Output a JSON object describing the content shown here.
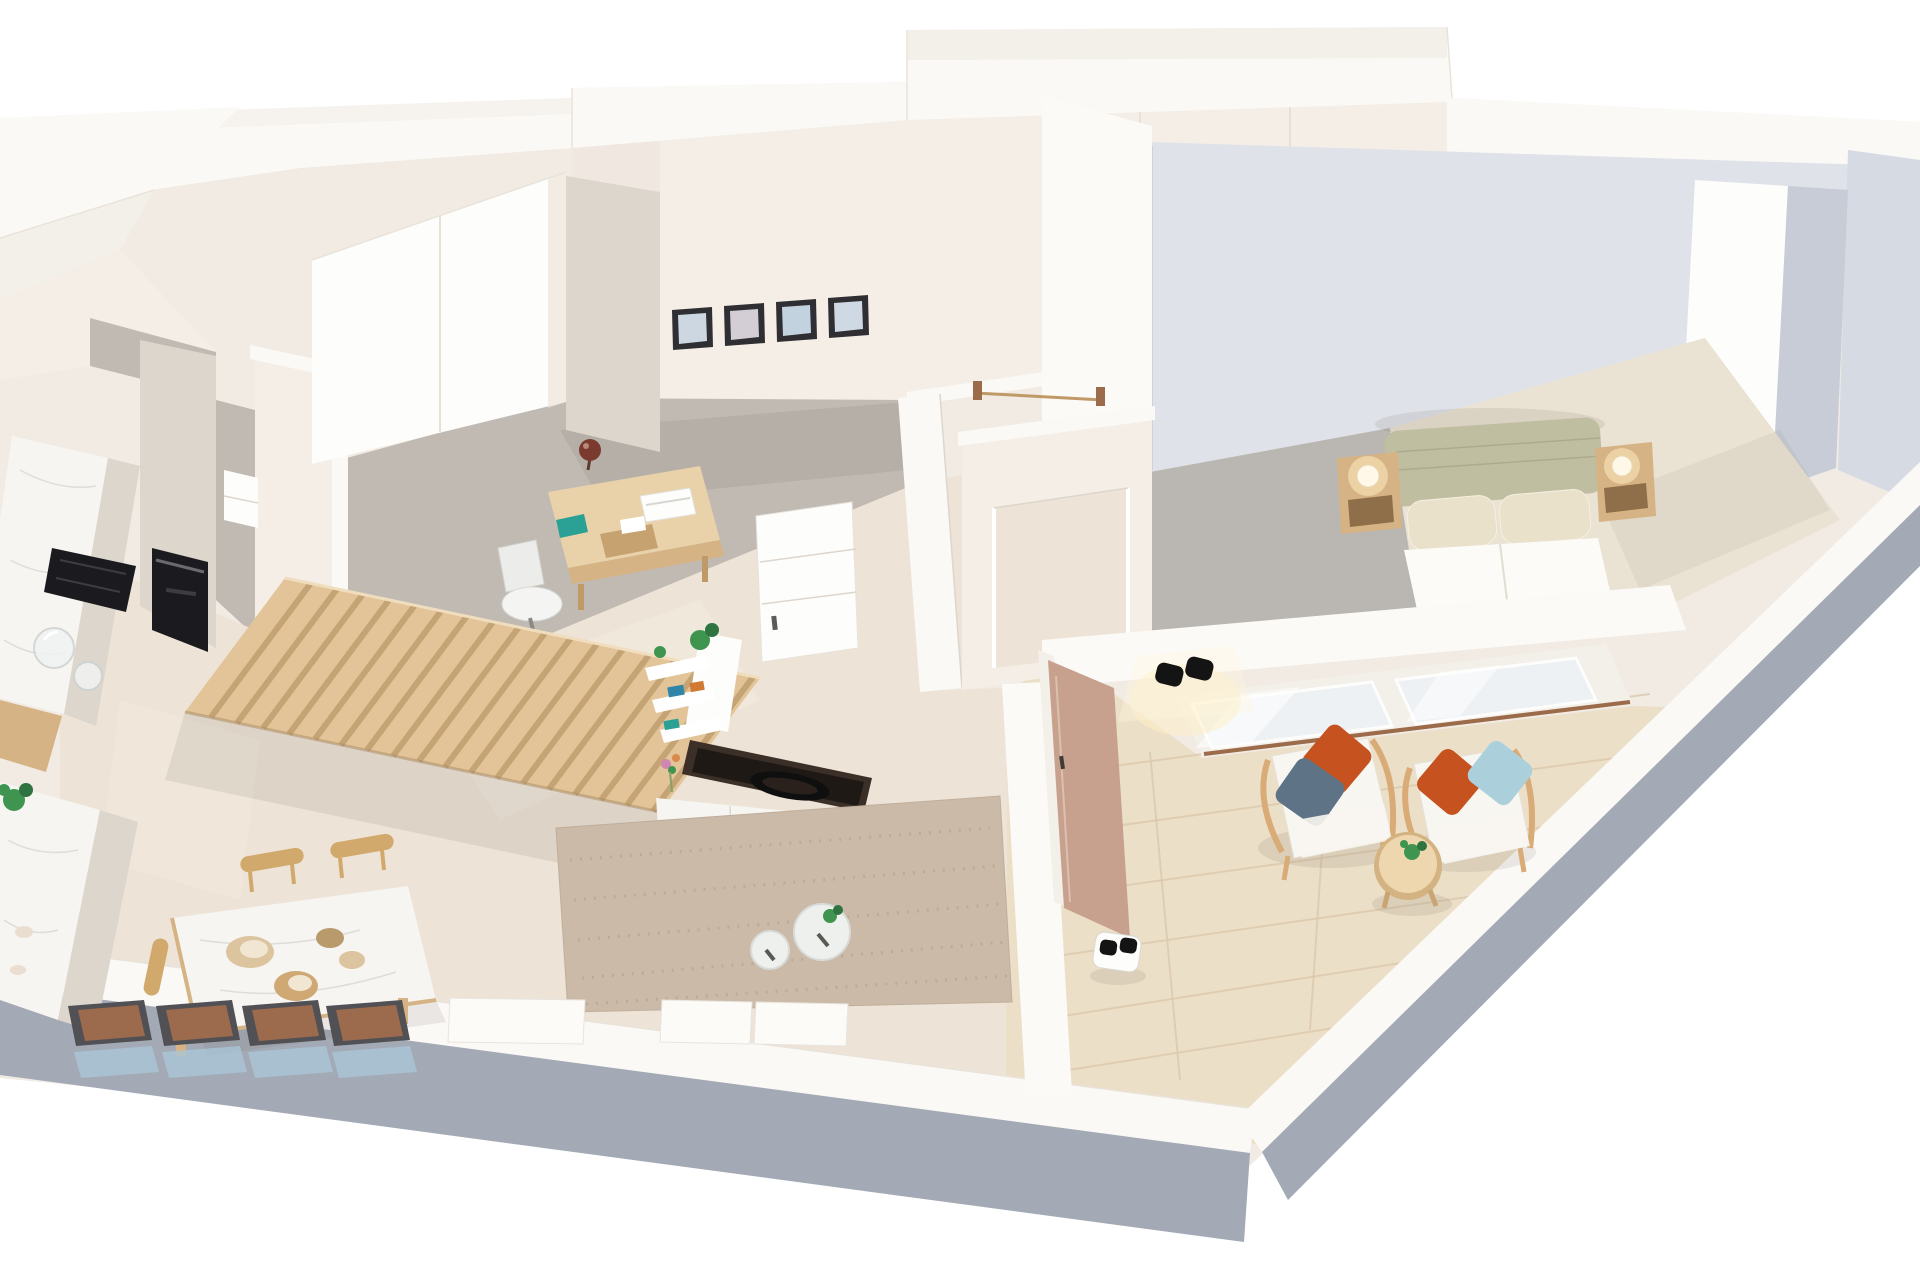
{
  "colors": {
    "bg": "#ffffff",
    "mass": "#f1ebe4",
    "wall_top": "#fbf9f6",
    "wall_top_shade": "#f3efe9",
    "wall_face_warm": "#f4eee6",
    "wall_face_warm_dark": "#ece4da",
    "wall_face_gray": "#dfe2e9",
    "wall_face_gray_dark": "#d6dae2",
    "wall_slot_gray": "#c7ccd6",
    "outer_face": "#a3aab5",
    "divider_white": "#fcfaf7",
    "floor_concrete": "#c1bab3",
    "floor_concrete_dark": "#b5aea7",
    "floor_cream": "#ede3d6",
    "floor_cream_light": "#f5eee2",
    "floor_wood": "#ecdfc8",
    "plank_line": "#dcc9ad",
    "carpet_gray": "#bab6b1",
    "carpet_cream": "#eae2d2",
    "rug": "#cbbaa8",
    "rug_dot": "#b3a08e",
    "marble": "#f7f5f2",
    "cabinet_beige": "#ddd6cd",
    "wood_light": "#e9d2a9",
    "wood_mid": "#d6b384",
    "wood_dark": "#c09a66",
    "slat_wood": "#e2c498",
    "slat_gap": "#bf9e70",
    "appliance_black": "#1b1b1f",
    "tv_frame": "#3b2f28",
    "tv_screen": "#1e1915",
    "tv_handle": "#0f0f0f",
    "headboard_sage": "#bfbea1",
    "pillow_cream": "#eae1cb",
    "duvet": "#fcfbf8",
    "pillow_orange": "#c5521f",
    "pillow_slate": "#5e7386",
    "pillow_blue": "#abd0dc",
    "plant": "#3f9550",
    "plant_dark": "#2e7340",
    "lamp_glow": "#ffefc4",
    "lamp_body": "#fff8e8",
    "sconce": "#141414",
    "door_tan": "#c7a18e",
    "chair_frame": "#515055",
    "chair_seat": "#9c6b4d",
    "shadow_blue": "#a9c7da",
    "shadow": "#6f6458",
    "white": "#ffffff",
    "near_white": "#fdfdfb",
    "glass_blue": "#eef2f5",
    "glass_jar": "#f1f3f2",
    "track_brown": "#9c6b4a",
    "sphere_lamp": "#7a3b2e",
    "teal": "#2ba094",
    "book_blue": "#2f86a8",
    "book_orange": "#d07a33",
    "frame_dark": "#2e2e33",
    "art_blue": "#ccd7e2",
    "art_pink": "#d3cdd6",
    "art_blue2": "#c3d2df",
    "art_blue3": "#cfd9e3",
    "shell": "#e9ded0",
    "bowl_tan": "#dcc49e",
    "bowl_brown": "#cfa873",
    "bowl_dark": "#b99a6d",
    "bowl_inner": "#f0e6d2",
    "seat_wood": "#d2a96c",
    "cushion_white": "#f8f6f1",
    "table_glass": "#eef0ed"
  },
  "scene": {
    "type": "3d-floor-plan-render",
    "view": "isometric-top",
    "rooms": [
      "kitchen",
      "dining-area",
      "home-office",
      "living-room",
      "hallway",
      "bedroom",
      "terrace"
    ],
    "counts": {
      "picture_frames": 4,
      "bar_chairs": 4,
      "dining_chairs": 3,
      "armchairs": 2,
      "living_coffee_tables": 2,
      "table_bowls": 4,
      "glass_jars": 2,
      "bedside_lamps": 2,
      "nightstands": 2,
      "sofa_sections": 3
    },
    "furniture": {
      "kitchen": [
        "tall-cabinet",
        "built-in-oven",
        "induction-hob",
        "marble-counter",
        "kitchen-island",
        "glass-jars",
        "shelf-niche",
        "plant",
        "shell-decor"
      ],
      "dining_area": [
        "marble-dining-table",
        "decor-bowls",
        "wooden-chairs",
        "bar-chair-row"
      ],
      "home_office": [
        "wardrobe",
        "tall-beige-cabinet",
        "picture-frames",
        "wooden-desk",
        "sphere-lamp",
        "laptop",
        "wood-tray",
        "office-chair",
        "white-drawer-door"
      ],
      "living_room": [
        "slat-partition",
        "white-shelf-unit",
        "tv-sideboard",
        "tv-panel",
        "speckled-rug",
        "round-glass-tables",
        "sofa"
      ],
      "hallway": [
        "coat-rail",
        "doorway-opening"
      ],
      "bedroom": [
        "sage-headboard-bed",
        "pillows",
        "duvet",
        "nightstand-left",
        "nightstand-right",
        "glow-lamps",
        "sliding-glass-door",
        "built-in-wardrobe-niche"
      ],
      "terrace": [
        "wall-sconce",
        "entrance-door",
        "wicker-armchair-1",
        "wicker-armchair-2",
        "round-wood-table",
        "table-plant",
        "robot-vacuum",
        "wood-deck"
      ]
    }
  }
}
